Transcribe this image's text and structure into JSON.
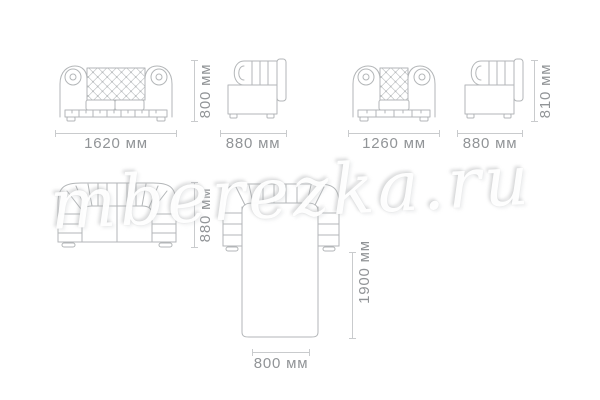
{
  "watermark": {
    "text": "mberezka.ru"
  },
  "drawings": {
    "sofa_front": {
      "width_label": "1620 мм",
      "height_label": "800 мм"
    },
    "sofa_side": {
      "depth_label": "880 мм"
    },
    "chair_front": {
      "width_label": "1260 мм"
    },
    "chair_side": {
      "depth_label": "880 мм",
      "height_label": "810 мм"
    },
    "sofa_top": {
      "depth_label": "880 мм"
    },
    "sofa_unfolded": {
      "length_label": "1900 мм",
      "width_label": "800 мм"
    }
  },
  "colors": {
    "background": "#ffffff",
    "line_art": "#b3b6b8",
    "dimension_line": "#c9cbcd",
    "label_text": "#919497",
    "watermark": "#f2f3f3"
  }
}
